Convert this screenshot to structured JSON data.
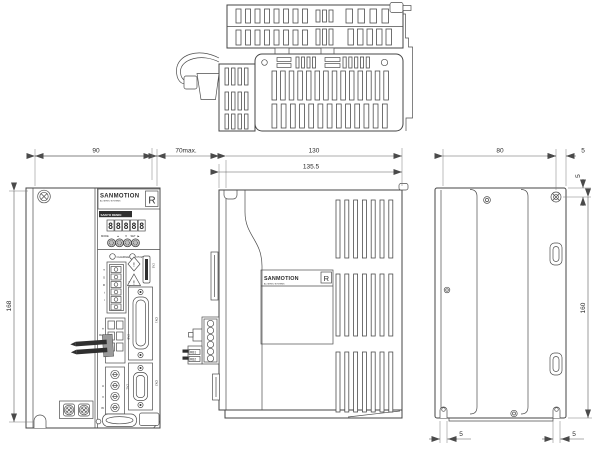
{
  "views": {
    "front": {
      "dim_width": "90",
      "dim_height": "168",
      "panel": {
        "brand": "SANMOTION",
        "brand_sub": "AC SERVO SYSTEMS",
        "brand_mark": "R",
        "maker_label": "SANYO DENKI",
        "display_digits": [
          "8",
          "8",
          "8",
          "8",
          "8"
        ],
        "key_mode": "MODE",
        "key_up": "▲",
        "key_down": "▼",
        "key_set": "SET",
        "key_set_arrow": "▶",
        "led_charge": "CHARGE",
        "led_power": "POWER",
        "warn_diamond": "!",
        "warn_triangle": "!",
        "terminals_power": [
          "T",
          "S",
          "R",
          "t",
          "r"
        ],
        "terminals_regen": [
          "⊖",
          "RL1",
          "RL2"
        ],
        "terminals_motor": [
          "U",
          "V",
          "W"
        ],
        "conn_cna": "CNA",
        "conn_cnb": "CNB",
        "conn_cnc": "CNC",
        "conn_cn1": "CN1",
        "conn_cn2": "CN2",
        "conn_cn3": "CN3"
      }
    },
    "side": {
      "dim_clearance": "70max.",
      "dim_depth_body": "130",
      "dim_depth_total": "135.5",
      "label_brand": "SANMOTION",
      "label_sub": "AC SERVO SYSTEMS",
      "label_mark": "R",
      "pin_rb1": "RB1",
      "pin_rb2": "RB2"
    },
    "back": {
      "dim_width": "80",
      "dim_offset_right": "5",
      "dim_offset_top": "5",
      "dim_height": "160",
      "dim_slot_left": "5",
      "dim_slot_right": "5"
    }
  }
}
